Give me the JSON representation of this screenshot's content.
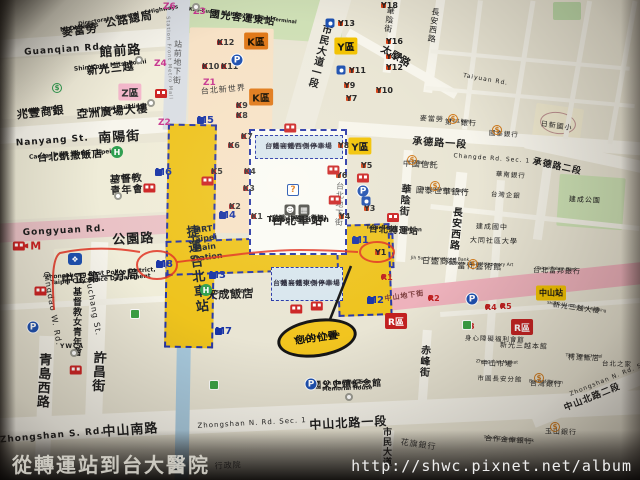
{
  "colors": {
    "mrt_yellow": "#eec31d",
    "road_pink": "#eac2c6",
    "mall_pink": "#eeb2bc",
    "walkway_blue": "#2636a8",
    "annotation_red": "#e03020",
    "map_bg": "#e9e5d4"
  },
  "watermarks": {
    "caption": "從轉運站到台大醫院",
    "url": "http://shwc.pixnet.net/album"
  },
  "you_are_here": {
    "zh": "您的位置",
    "en": "You are here"
  },
  "mrt_band": {
    "zh": "捷運台北車站",
    "en": "MRT Taipei Main Station"
  },
  "station_box": {
    "west_zh": "台鐵高鐵西側停車場",
    "west_en": "TRA & HSR West Parking Lot",
    "east_zh": "台鐵高鐵東側停車場",
    "east_en": "TRA & HSR East Parking Lot",
    "name_zh": "台北車站",
    "name_sub": "(台鐵、高鐵、微風)",
    "name_en": "Taipei Station",
    "name_en_sub": "(TRA・HSR・Breeze)",
    "info_icon": "?"
  },
  "map_labels": [
    {
      "t": "館前路",
      "x": 120,
      "y": 45,
      "s": 13,
      "r": -4,
      "b": 1
    },
    {
      "t": "Guanqian Rd.",
      "x": 64,
      "y": 46,
      "s": 9,
      "r": -4,
      "b": 1
    },
    {
      "t": "南陽街",
      "x": 119,
      "y": 131,
      "s": 13,
      "r": -3,
      "b": 1
    },
    {
      "t": "Nanyang St.",
      "x": 52,
      "y": 137,
      "s": 9,
      "r": -4,
      "b": 1
    },
    {
      "t": "公園路",
      "x": 133,
      "y": 233,
      "s": 13,
      "r": -3,
      "b": 1
    },
    {
      "t": "Gongyuan Rd.",
      "x": 64,
      "y": 227,
      "s": 9,
      "r": -3,
      "b": 1
    },
    {
      "t": "中山南路",
      "x": 130,
      "y": 424,
      "s": 13,
      "r": -4,
      "b": 1
    },
    {
      "t": "Zhongshan S. Rd.",
      "x": 52,
      "y": 432,
      "s": 9,
      "r": -5,
      "b": 1
    },
    {
      "t": "中山北路一段",
      "x": 348,
      "y": 417,
      "s": 12,
      "r": -3,
      "b": 1
    },
    {
      "t": "Zhongshan N. Rd. Sec. 1",
      "x": 252,
      "y": 420,
      "s": 7,
      "r": -3
    },
    {
      "t": "中山北路二段",
      "x": 591,
      "y": 394,
      "s": 9,
      "r": -22,
      "b": 1
    },
    {
      "t": "Zhongshan N. Rd. Sec. 2",
      "x": 614,
      "y": 374,
      "s": 6,
      "r": -22
    },
    {
      "t": "市民大道一段",
      "x": 323,
      "y": 57,
      "s": 10,
      "v": 1,
      "r": 14,
      "b": 1
    },
    {
      "t": "承德路一段",
      "x": 440,
      "y": 139,
      "s": 10,
      "r": 4,
      "b": 1
    },
    {
      "t": "Changde Rd. Sec. 1",
      "x": 492,
      "y": 156,
      "s": 6,
      "r": 4
    },
    {
      "t": "承德路二段",
      "x": 558,
      "y": 163,
      "s": 9,
      "r": 12,
      "b": 1
    },
    {
      "t": "太原路",
      "x": 398,
      "y": 53,
      "s": 10,
      "r": 30,
      "b": 1
    },
    {
      "t": "Taiyuan Rd.",
      "x": 486,
      "y": 77,
      "s": 6,
      "r": 10
    },
    {
      "t": "華陰街",
      "x": 393,
      "y": 20,
      "s": 8,
      "v": 1,
      "r": 8
    },
    {
      "t": "華陰街",
      "x": 408,
      "y": 200,
      "s": 10,
      "v": 1,
      "r": 5,
      "b": 1
    },
    {
      "t": "長安西路",
      "x": 437,
      "y": 26,
      "s": 8,
      "v": 1,
      "r": 8
    },
    {
      "t": "長安西路",
      "x": 459,
      "y": 229,
      "s": 10,
      "v": 1,
      "r": 5,
      "b": 1
    },
    {
      "t": "赤峰街",
      "x": 428,
      "y": 361,
      "s": 10,
      "v": 1,
      "r": 3,
      "b": 1
    },
    {
      "t": "許昌街",
      "x": 104,
      "y": 372,
      "s": 13,
      "v": 1,
      "r": 3,
      "b": 1
    },
    {
      "t": "Xuchang St.",
      "x": 97,
      "y": 306,
      "s": 8,
      "r": 80
    },
    {
      "t": "青島西路",
      "x": 49,
      "y": 381,
      "s": 13,
      "v": 1,
      "r": 3,
      "b": 1
    },
    {
      "t": "Qingdao W. Rd.",
      "x": 56,
      "y": 308,
      "s": 8,
      "r": 80
    },
    {
      "t": "市民大道",
      "x": 390,
      "y": 447,
      "s": 9,
      "v": 1,
      "b": 1
    },
    {
      "t": "站前地下街",
      "x": 181,
      "y": 62,
      "s": 8,
      "v": 1,
      "r": 2,
      "c": "#555"
    },
    {
      "t": "Station Front Metro Mall",
      "x": 171,
      "y": 58,
      "s": 5,
      "r": 88,
      "c": "#777"
    },
    {
      "t": "台北地下街",
      "x": 343,
      "y": 204,
      "s": 8,
      "v": 1,
      "r": 2,
      "c": "#555"
    },
    {
      "t": "中山地下街",
      "x": 404,
      "y": 293,
      "s": 7,
      "r": -8,
      "c": "#7a3a3a",
      "b": 1
    },
    {
      "t": "公路總局",
      "e": "Directorate General of Highways",
      "x": 128,
      "y": 14,
      "s": 11,
      "es": 5.5,
      "r": -10,
      "b": 1
    },
    {
      "t": "麥當勞",
      "e": "McDonald's",
      "x": 79,
      "y": 25,
      "s": 11,
      "es": 6,
      "r": -8,
      "b": 1
    },
    {
      "t": "新光三越",
      "e": "Shin Kong Mitsukoshi",
      "x": 110,
      "y": 63,
      "s": 11,
      "es": 6,
      "r": -6,
      "b": 1
    },
    {
      "t": "亞洲廣場大樓",
      "e": "Asia Plaza Building",
      "x": 112,
      "y": 106,
      "s": 11,
      "es": 6,
      "r": -5,
      "b": 1
    },
    {
      "t": "兆豐商銀",
      "e": "Mega Bank",
      "x": 40,
      "y": 107,
      "s": 11,
      "es": 6,
      "r": -6,
      "b": 1
    },
    {
      "t": "台北凱撒飯店",
      "e": "Caesar Park Hotel Taipei",
      "x": 70,
      "y": 152,
      "s": 10,
      "es": 6,
      "r": -4,
      "b": 1
    },
    {
      "t": "基督教\n青年會",
      "e": "YMCA",
      "x": 126,
      "y": 175,
      "s": 10,
      "es": 6,
      "r": -4,
      "b": 1
    },
    {
      "t": "中正第一分局",
      "e": "Zhongzheng First Police District,\nTaipei City Police Department",
      "x": 100,
      "y": 271,
      "s": 12,
      "es": 6,
      "r": -4,
      "b": 1
    },
    {
      "t": "基督教女青年會",
      "x": 80,
      "y": 322,
      "s": 9,
      "v": 1,
      "b": 1
    },
    {
      "t": "YWCA",
      "x": 72,
      "y": 344,
      "s": 6,
      "b": 1
    },
    {
      "t": "國光客運東站",
      "e": "Kuo-Kuang Highway Bus East Terminal",
      "x": 243,
      "y": 14,
      "s": 10,
      "es": 5,
      "r": 7,
      "b": 1
    },
    {
      "t": "台北新世界",
      "x": 223,
      "y": 86,
      "s": 8,
      "r": -5,
      "c": "#333"
    },
    {
      "t": "天成飯店",
      "e": "Cosmos Hotel",
      "x": 230,
      "y": 289,
      "s": 11,
      "es": 6,
      "r": -2,
      "b": 1
    },
    {
      "t": "國父史蹟紀念館",
      "e": "Dr. Sun Yat-Sen\nMemorial House",
      "x": 347,
      "y": 381,
      "s": 9,
      "es": 5.5,
      "r": -2,
      "b": 1
    },
    {
      "t": "台北轉運站",
      "e": "Taipei Bus Station",
      "x": 394,
      "y": 227,
      "s": 9,
      "es": 5.5,
      "r": 3,
      "b": 1
    },
    {
      "t": "中國信託",
      "e": "Chinatrust",
      "x": 421,
      "y": 161,
      "s": 8,
      "es": 5,
      "r": 3
    },
    {
      "t": "國泰世華銀行",
      "e": "Cathay United Bank",
      "x": 443,
      "y": 188,
      "s": 8,
      "es": 5,
      "r": 3
    },
    {
      "t": "第一銀行",
      "e": "First Bank",
      "x": 461,
      "y": 120,
      "s": 7,
      "es": 4.5,
      "r": 3
    },
    {
      "t": "麥當勞",
      "x": 432,
      "y": 116,
      "s": 7,
      "r": 3
    },
    {
      "t": "日新國小",
      "x": 557,
      "y": 123,
      "s": 7,
      "r": 8
    },
    {
      "t": "建成公園",
      "x": 585,
      "y": 197,
      "s": 7,
      "r": 3
    },
    {
      "t": "當代藝術館",
      "e": "Museum of Contemporary Art",
      "x": 480,
      "y": 263,
      "s": 8,
      "es": 4.5,
      "r": 2
    },
    {
      "t": "建成國中",
      "x": 492,
      "y": 224,
      "s": 7,
      "r": 2
    },
    {
      "t": "大同社區大學",
      "x": 494,
      "y": 238,
      "s": 7,
      "r": 2
    },
    {
      "t": "日盛商銀",
      "e": "Jih Sun International Bank",
      "x": 440,
      "y": 258,
      "s": 8,
      "es": 4.5,
      "r": 2
    },
    {
      "t": "台北富邦銀行",
      "e": "Taipei Fubon Bank",
      "x": 557,
      "y": 268,
      "s": 7,
      "es": 4.5,
      "r": 2
    },
    {
      "t": "新光三越大樓",
      "e": "Shin Kong Mitsukoshi Building",
      "x": 577,
      "y": 305,
      "s": 7,
      "es": 4,
      "r": 8
    },
    {
      "t": "新光三越本館",
      "x": 524,
      "y": 343,
      "s": 7,
      "r": 2
    },
    {
      "t": "中山市場",
      "e": "Zhongshan Market",
      "x": 497,
      "y": 361,
      "s": 7,
      "es": 4.5,
      "r": 2
    },
    {
      "t": "市圖長安分館",
      "x": 500,
      "y": 376,
      "s": 6.5,
      "r": 2
    },
    {
      "t": "身心障礙福利會館",
      "x": 495,
      "y": 336,
      "s": 6.5,
      "r": 2
    },
    {
      "t": "台灣銀行",
      "e": "Bank of Taiwan",
      "x": 546,
      "y": 381,
      "s": 7,
      "es": 4.5,
      "r": 2
    },
    {
      "t": "玉山銀行",
      "x": 561,
      "y": 429,
      "s": 7,
      "r": 2
    },
    {
      "t": "柯達飯店",
      "e": "THE Tango Hotel",
      "x": 584,
      "y": 355,
      "s": 7,
      "es": 4.5,
      "r": 2
    },
    {
      "t": "台北之家",
      "x": 617,
      "y": 361,
      "s": 6.5,
      "r": 2
    },
    {
      "t": "花旗銀行",
      "x": 419,
      "y": 441,
      "s": 8,
      "r": 8,
      "c": "#333"
    },
    {
      "t": "合作金庫銀行",
      "e": "Taiwan Cooperative Bank",
      "x": 509,
      "y": 437,
      "s": 7,
      "es": 4,
      "r": 4
    },
    {
      "t": "行政院",
      "x": 228,
      "y": 462,
      "s": 8,
      "r": -3,
      "c": "#444"
    },
    {
      "t": "國泰銀行",
      "x": 504,
      "y": 131,
      "s": 6.5,
      "r": 4
    },
    {
      "t": "華南銀行",
      "x": 511,
      "y": 172,
      "s": 6.5,
      "r": 4
    },
    {
      "t": "台灣企銀",
      "x": 506,
      "y": 192,
      "s": 6.5,
      "r": 4
    }
  ],
  "stations": [
    {
      "k": "M",
      "t": "M1",
      "x": 352,
      "y": 240
    },
    {
      "k": "M",
      "t": "M2",
      "x": 367,
      "y": 300
    },
    {
      "k": "M",
      "t": "M3",
      "x": 209,
      "y": 275
    },
    {
      "k": "M",
      "t": "M4",
      "x": 219,
      "y": 215
    },
    {
      "k": "M",
      "t": "M5",
      "x": 197,
      "y": 120
    },
    {
      "k": "M",
      "t": "M6",
      "x": 155,
      "y": 172
    },
    {
      "k": "M",
      "t": "M7",
      "x": 215,
      "y": 331
    },
    {
      "k": "M",
      "t": "M8",
      "x": 156,
      "y": 264
    },
    {
      "k": "Y",
      "t": "Y18",
      "x": 381,
      "y": 5
    },
    {
      "k": "Y",
      "t": "Y16",
      "x": 386,
      "y": 41
    },
    {
      "k": "Y",
      "t": "Y14",
      "x": 386,
      "y": 56
    },
    {
      "k": "Y",
      "t": "Y12",
      "x": 386,
      "y": 67
    },
    {
      "k": "Y",
      "t": "Y13",
      "x": 338,
      "y": 23
    },
    {
      "k": "Y",
      "t": "Y11",
      "x": 349,
      "y": 70
    },
    {
      "k": "Y",
      "t": "Y10",
      "x": 376,
      "y": 90
    },
    {
      "k": "Y",
      "t": "Y9",
      "x": 344,
      "y": 85
    },
    {
      "k": "Y",
      "t": "Y7",
      "x": 346,
      "y": 98
    },
    {
      "k": "Y",
      "t": "Y8",
      "x": 338,
      "y": 145
    },
    {
      "k": "Y",
      "t": "Y6",
      "x": 336,
      "y": 175
    },
    {
      "k": "Y",
      "t": "Y5",
      "x": 361,
      "y": 165
    },
    {
      "k": "Y",
      "t": "Y4",
      "x": 339,
      "y": 216
    },
    {
      "k": "Y",
      "t": "Y3",
      "x": 364,
      "y": 208
    },
    {
      "k": "Y",
      "t": "Y1",
      "x": 375,
      "y": 252
    },
    {
      "k": "Z",
      "t": "Z6",
      "x": 163,
      "y": 7
    },
    {
      "k": "Z",
      "t": "Z4",
      "x": 154,
      "y": 64
    },
    {
      "k": "Z",
      "t": "Z2",
      "x": 158,
      "y": 123
    },
    {
      "k": "Z",
      "t": "Z3",
      "x": 193,
      "y": 12
    },
    {
      "k": "Z",
      "t": "Z1",
      "x": 203,
      "y": 83
    },
    {
      "k": "K",
      "t": "K12",
      "x": 217,
      "y": 42
    },
    {
      "k": "K",
      "t": "K10",
      "x": 202,
      "y": 66
    },
    {
      "k": "K",
      "t": "K11",
      "x": 221,
      "y": 66
    },
    {
      "k": "K",
      "t": "K9",
      "x": 236,
      "y": 105
    },
    {
      "k": "K",
      "t": "K8",
      "x": 236,
      "y": 115
    },
    {
      "k": "K",
      "t": "K7",
      "x": 241,
      "y": 136
    },
    {
      "k": "K",
      "t": "K6",
      "x": 228,
      "y": 145
    },
    {
      "k": "K",
      "t": "K5",
      "x": 211,
      "y": 171
    },
    {
      "k": "K",
      "t": "K4",
      "x": 244,
      "y": 171
    },
    {
      "k": "K",
      "t": "K3",
      "x": 243,
      "y": 188
    },
    {
      "k": "K",
      "t": "K2",
      "x": 229,
      "y": 206
    },
    {
      "k": "K",
      "t": "K1",
      "x": 251,
      "y": 216
    },
    {
      "k": "R",
      "t": "R1",
      "x": 381,
      "y": 277
    },
    {
      "k": "R",
      "t": "R2",
      "x": 428,
      "y": 298
    },
    {
      "k": "R",
      "t": "R4",
      "x": 485,
      "y": 307
    },
    {
      "k": "R",
      "t": "R5",
      "x": 500,
      "y": 306
    },
    {
      "k": "R",
      "t": "R3",
      "x": 463,
      "y": 326
    }
  ],
  "zone_boxes": [
    {
      "k": "K",
      "t": "K區",
      "x": 256,
      "y": 41
    },
    {
      "k": "K",
      "t": "K區",
      "x": 261,
      "y": 97
    },
    {
      "k": "Y",
      "t": "Y區",
      "x": 346,
      "y": 46
    },
    {
      "k": "Y",
      "t": "Y區",
      "x": 360,
      "y": 146
    },
    {
      "k": "Z",
      "t": "Z區",
      "x": 130,
      "y": 92
    },
    {
      "k": "R",
      "t": "R區",
      "x": 396,
      "y": 321
    },
    {
      "k": "R",
      "t": "R區",
      "x": 522,
      "y": 327
    },
    {
      "k": "N",
      "t": "中山站",
      "x": 551,
      "y": 293
    }
  ],
  "bus_stops": [
    {
      "t": "M",
      "x": 27,
      "y": 246,
      "a": 1
    },
    {
      "t": "L",
      "x": 38,
      "y": 291
    },
    {
      "t": "K",
      "x": 74,
      "y": 370
    },
    {
      "t": "H",
      "x": 148,
      "y": 188
    },
    {
      "t": "G",
      "x": 206,
      "y": 181
    },
    {
      "t": "E",
      "x": 288,
      "y": 128
    },
    {
      "t": "D",
      "x": 332,
      "y": 170
    },
    {
      "t": "C",
      "x": 361,
      "y": 178
    },
    {
      "t": "A",
      "x": 333,
      "y": 200
    },
    {
      "t": "F",
      "x": 294,
      "y": 309
    },
    {
      "t": "B",
      "x": 315,
      "y": 306
    },
    {
      "t": "",
      "x": 155,
      "y": 93
    },
    {
      "t": "",
      "x": 387,
      "y": 217
    }
  ],
  "icons": [
    {
      "k": "P",
      "x": 237,
      "y": 60
    },
    {
      "k": "P",
      "x": 33,
      "y": 327
    },
    {
      "k": "P",
      "x": 363,
      "y": 191
    },
    {
      "k": "P",
      "x": 311,
      "y": 384
    },
    {
      "k": "P",
      "x": 472,
      "y": 299
    },
    {
      "k": "H",
      "x": 117,
      "y": 152
    },
    {
      "k": "H",
      "x": 206,
      "y": 290
    },
    {
      "k": "O",
      "x": 139,
      "y": 60
    },
    {
      "k": "O",
      "x": 151,
      "y": 103
    },
    {
      "k": "O",
      "x": 118,
      "y": 196
    },
    {
      "k": "O",
      "x": 196,
      "y": 7
    },
    {
      "k": "O",
      "x": 74,
      "y": 353
    },
    {
      "k": "O",
      "x": 349,
      "y": 397
    },
    {
      "k": "G",
      "x": 135,
      "y": 314
    },
    {
      "k": "G",
      "x": 214,
      "y": 385
    },
    {
      "k": "G",
      "x": 467,
      "y": 325
    },
    {
      "k": "M2",
      "x": 330,
      "y": 23
    },
    {
      "k": "M2",
      "x": 341,
      "y": 70
    },
    {
      "k": "M2",
      "x": 366,
      "y": 201
    },
    {
      "k": "D",
      "x": 57,
      "y": 88,
      "c": "#2e9e4f"
    },
    {
      "k": "D",
      "x": 412,
      "y": 160,
      "c": "#d07818"
    },
    {
      "k": "D",
      "x": 435,
      "y": 186,
      "c": "#d07818"
    },
    {
      "k": "D",
      "x": 453,
      "y": 119,
      "c": "#d07818"
    },
    {
      "k": "D",
      "x": 497,
      "y": 130,
      "c": "#d07818"
    },
    {
      "k": "D",
      "x": 539,
      "y": 378,
      "c": "#d07818"
    },
    {
      "k": "D",
      "x": 555,
      "y": 427,
      "c": "#d07818"
    },
    {
      "k": "D",
      "x": 473,
      "y": 264,
      "c": "#d07818"
    },
    {
      "k": "INFO",
      "x": 293,
      "y": 190
    },
    {
      "k": "BADGE",
      "x": 75,
      "y": 259
    },
    {
      "k": "FACE",
      "x": 290,
      "y": 210
    },
    {
      "k": "TRAIN",
      "x": 304,
      "y": 210
    }
  ]
}
